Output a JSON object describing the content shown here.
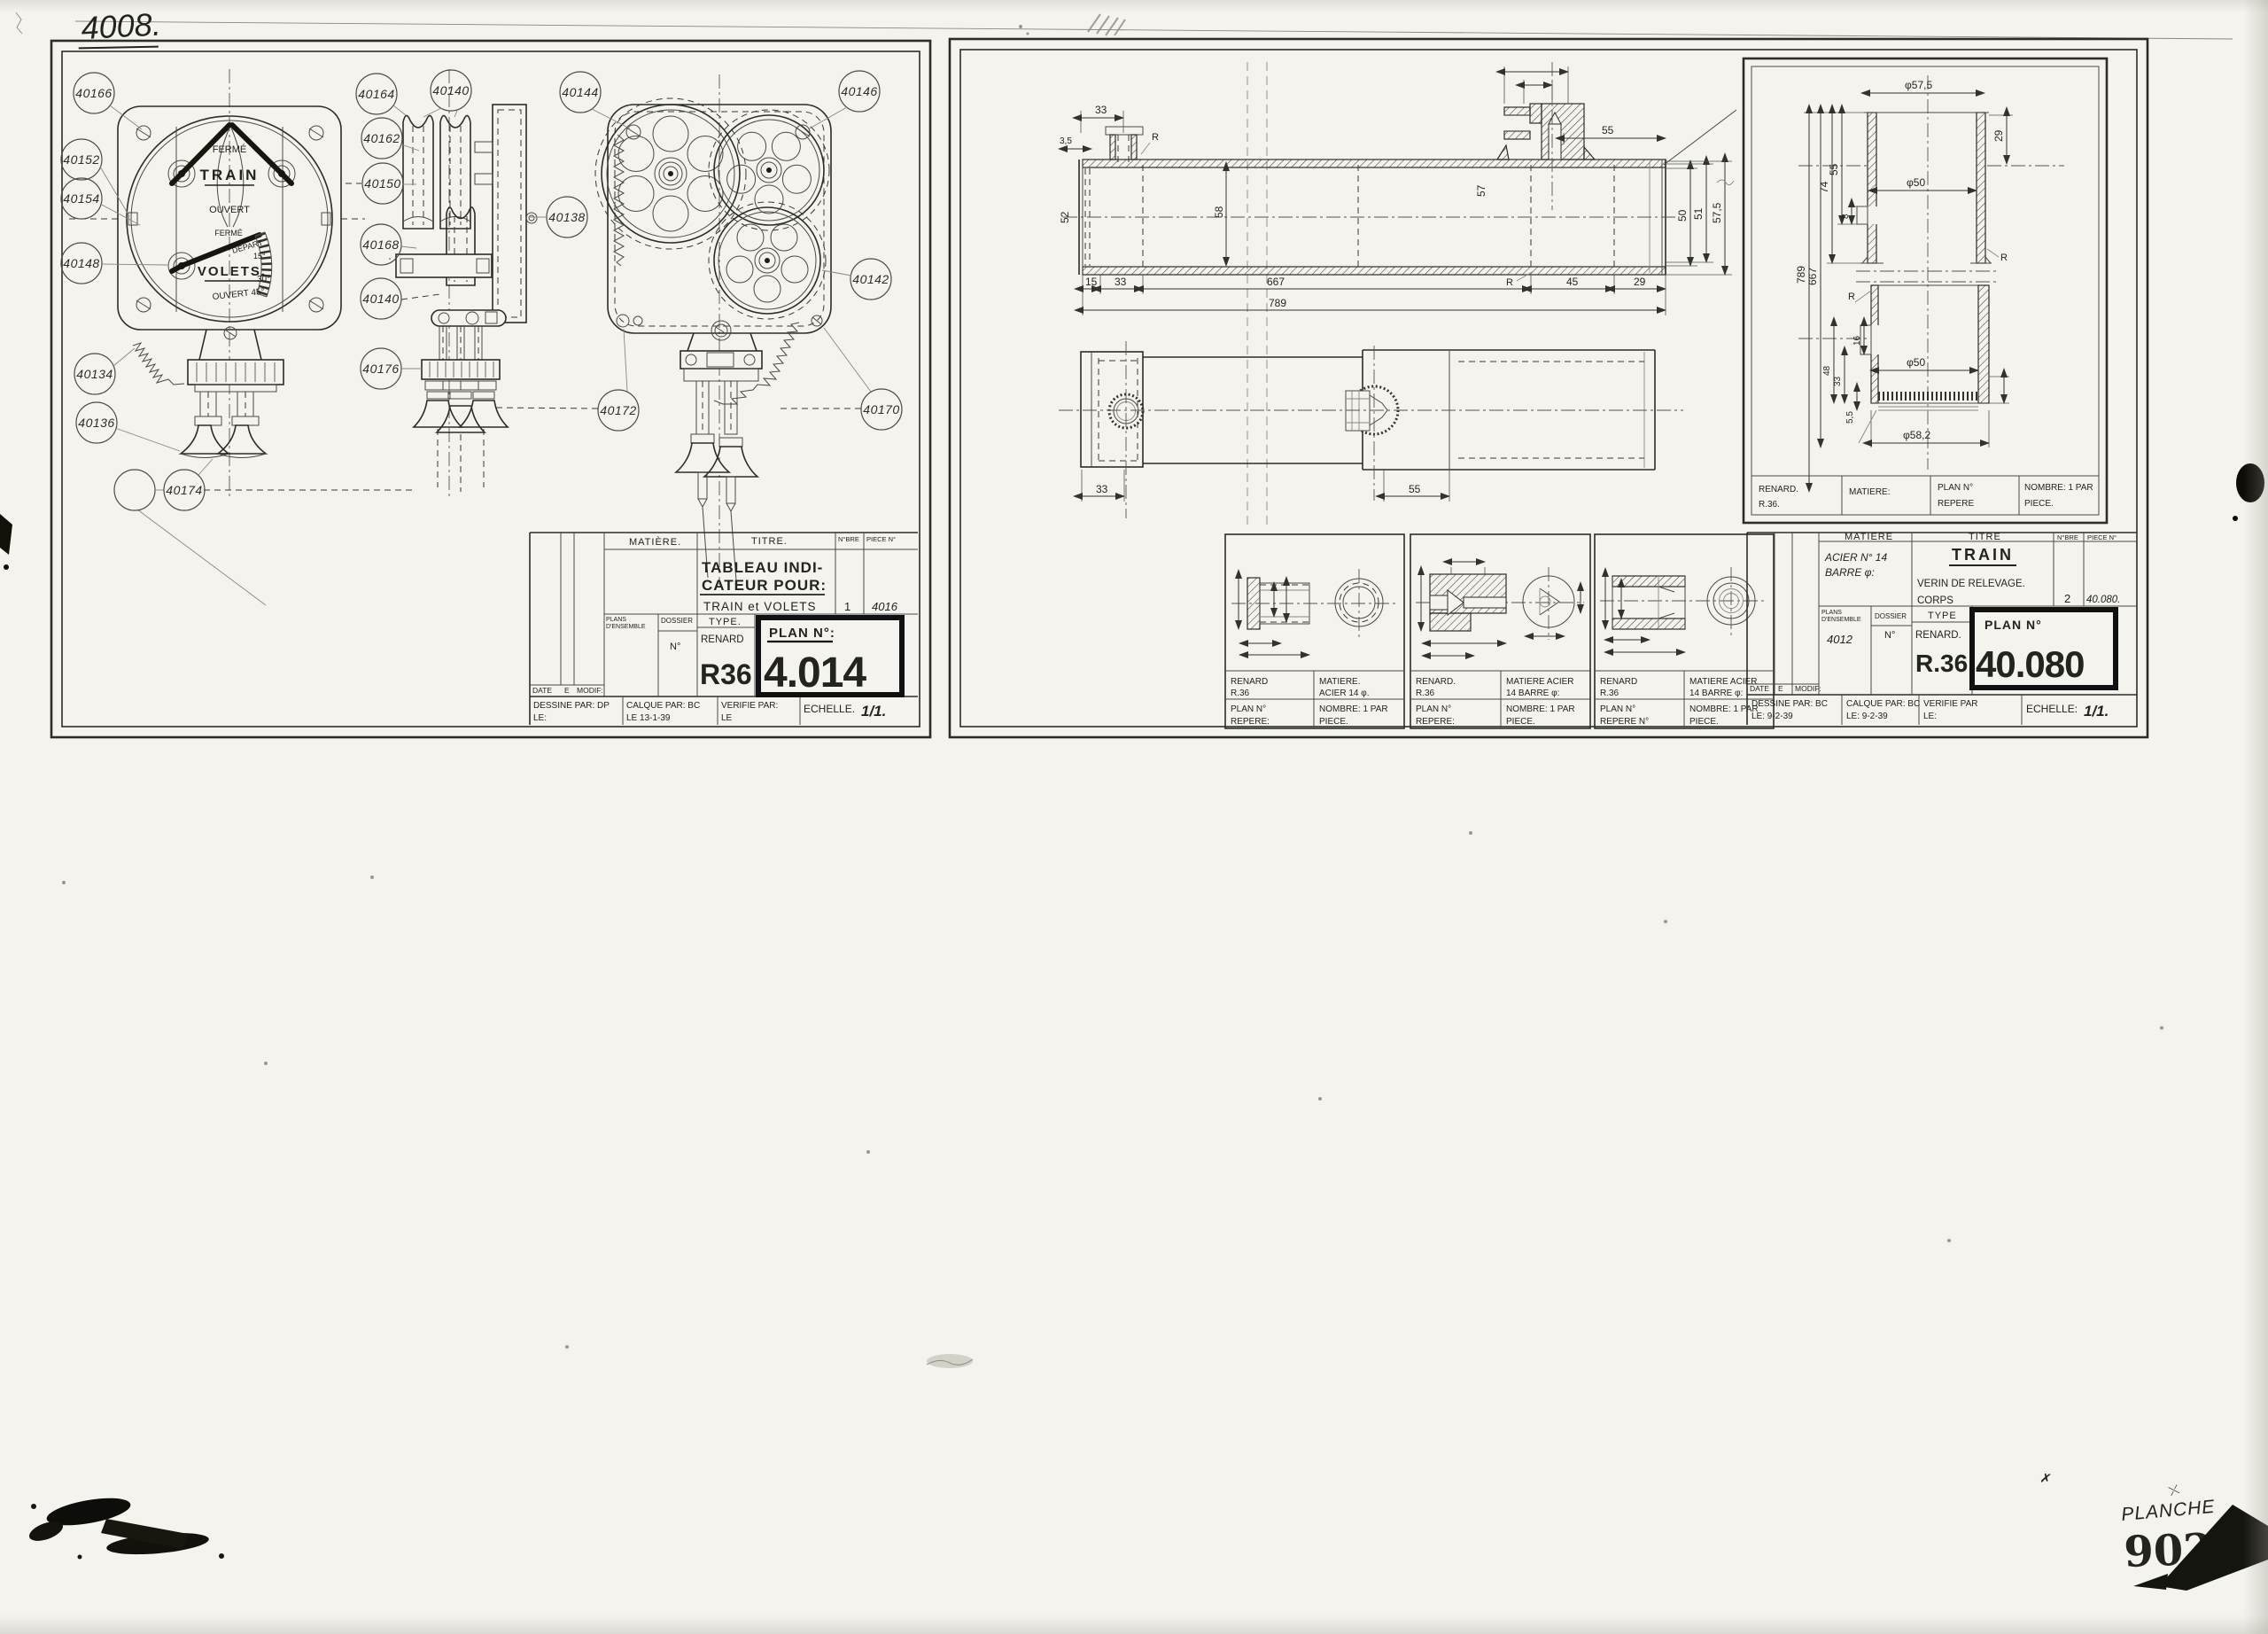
{
  "page": {
    "sheet_number": "4008.",
    "planche_label": "PLANCHE",
    "planche_number": "902"
  },
  "left_panel": {
    "dial": {
      "ferme_top": "FERMÉ",
      "train": "TRAIN",
      "ouvert": "OUVERT",
      "ferme_low": "FERMÉ",
      "volets": "VOLETS.",
      "depart": "DEPART",
      "deg15": "15°",
      "deg30": "30°",
      "ouvert45": "OUVERT 45°"
    },
    "callouts": [
      "40166",
      "40152",
      "40154",
      "40148",
      "40134",
      "40136",
      "",
      "40174",
      "40164",
      "40140",
      "40162",
      "40150",
      "40168",
      "40140",
      "40176",
      "40144",
      "40146",
      "40138",
      "40142",
      "40172",
      "40170"
    ],
    "title_block": {
      "matiere_label": "MATIÈRE.",
      "titre_label": "TITRE.",
      "nbre_label": "N°BRE",
      "piece_label": "PIECE N°",
      "title_line1": "TABLEAU INDI-",
      "title_line2": "CATEUR POUR:",
      "title_line3": "TRAIN et VOLETS",
      "nbre_value": "1",
      "piece_value": "4016",
      "plans_label1": "PLANS",
      "plans_label2": "D'ENSEMBLE",
      "dossier_label": "DOSSIER",
      "no_label": "N°",
      "type_label": "TYPE.",
      "type_value": "RENARD",
      "type_code": "R36",
      "plan_no_label": "PLAN N°:",
      "plan_no_value": "4.014",
      "date_label": "DATE",
      "e_label": "E",
      "modif_label": "MODIF:",
      "dessine": "DESSINE PAR: DP",
      "dessine_le": "LE:",
      "calque": "CALQUE PAR: BC",
      "calque_le": "LE 13-1-39",
      "verifie": "VERIFIE PAR:",
      "verifie_le": "LE",
      "echelle_label": "ECHELLE.",
      "echelle_value": "1/1."
    }
  },
  "right_panel": {
    "top_view": {
      "d33": "33",
      "d35": "3,5",
      "r1": "R",
      "d55": "55",
      "d52": "52",
      "d58": "58",
      "d57": "57",
      "d50": "50",
      "d51": "51",
      "d575": "57,5",
      "d15": "15",
      "d33b": "33",
      "d667": "667",
      "d45": "45",
      "d29": "29",
      "d789": "789",
      "r2": "R"
    },
    "side_view": {
      "d33": "33",
      "d55": "55"
    },
    "detail_panel": {
      "dims": {
        "dia575": "φ57,5",
        "d29": "29",
        "dia50a": "φ50",
        "d74": "74",
        "d55": "55",
        "d8": "8",
        "d789": "789",
        "d667": "667",
        "r1": "R",
        "r2": "R",
        "d16": "16",
        "d48": "48",
        "d33": "33",
        "dia50b": "φ50",
        "d55s": "5,5",
        "dia582": "φ58,2"
      },
      "strip": {
        "renard": "RENARD.",
        "code": "R.36.",
        "matiere": "MATIERE:",
        "plan": "PLAN N°",
        "repere": "REPERE",
        "nombre": "NOMBRE: 1 PAR",
        "piece": "PIECE."
      }
    },
    "detail_boxes": [
      {
        "renard": "RENARD",
        "code": "R.36",
        "mat1": "MATIERE.",
        "mat2": "ACIER 14 φ.",
        "plan": "PLAN N°",
        "repere": "REPERE:",
        "nombre": "NOMBRE: 1 PAR",
        "piece": "PIECE."
      },
      {
        "renard": "RENARD.",
        "code": "R.36",
        "mat1": "MATIERE ACIER",
        "mat2": "14 BARRE φ:",
        "plan": "PLAN N°",
        "repere": "REPERE:",
        "nombre": "NOMBRE: 1 PAR",
        "piece": "PIECE."
      },
      {
        "renard": "RENARD",
        "code": "R.36",
        "mat1": "MATIERE ACIER",
        "mat2": "14 BARRE φ:",
        "plan": "PLAN N°",
        "repere": "REPERE N°",
        "nombre": "NOMBRE: 1 PAR",
        "piece": "PIECE."
      }
    ],
    "title_block": {
      "matiere_label": "MATIERE",
      "titre_label": "TITRE",
      "nbre_label": "N°BRE",
      "piece_label": "PIECE N°",
      "matiere_line1": "ACIER N° 14",
      "matiere_line2": "BARRE φ:",
      "titre_main": "TRAIN",
      "titre_sub1": "VERIN DE RELEVAGE.",
      "titre_sub2": "CORPS",
      "nbre_value": "2",
      "piece_value": "40.080.",
      "plans_label1": "PLANS",
      "plans_label2": "D'ENSEMBLE",
      "plans_value": "4012",
      "dossier_label": "DOSSIER",
      "no_label": "N°",
      "type_label": "TYPE",
      "type_value": "RENARD.",
      "type_code": "R.36",
      "plan_no_label": "PLAN N°",
      "plan_no_value": "40.080",
      "date_label": "DATE",
      "e_label": "E",
      "modif_label": "MODIF:",
      "dessine": "DESSINE PAR: BC",
      "dessine_le": "LE: 9-2-39",
      "calque": "CALQUE PAR: BC",
      "calque_le": "LE: 9-2-39",
      "verifie": "VERIFIE PAR",
      "verifie_le": "LE:",
      "echelle_label": "ECHELLE:",
      "echelle_value": "1/1."
    }
  }
}
